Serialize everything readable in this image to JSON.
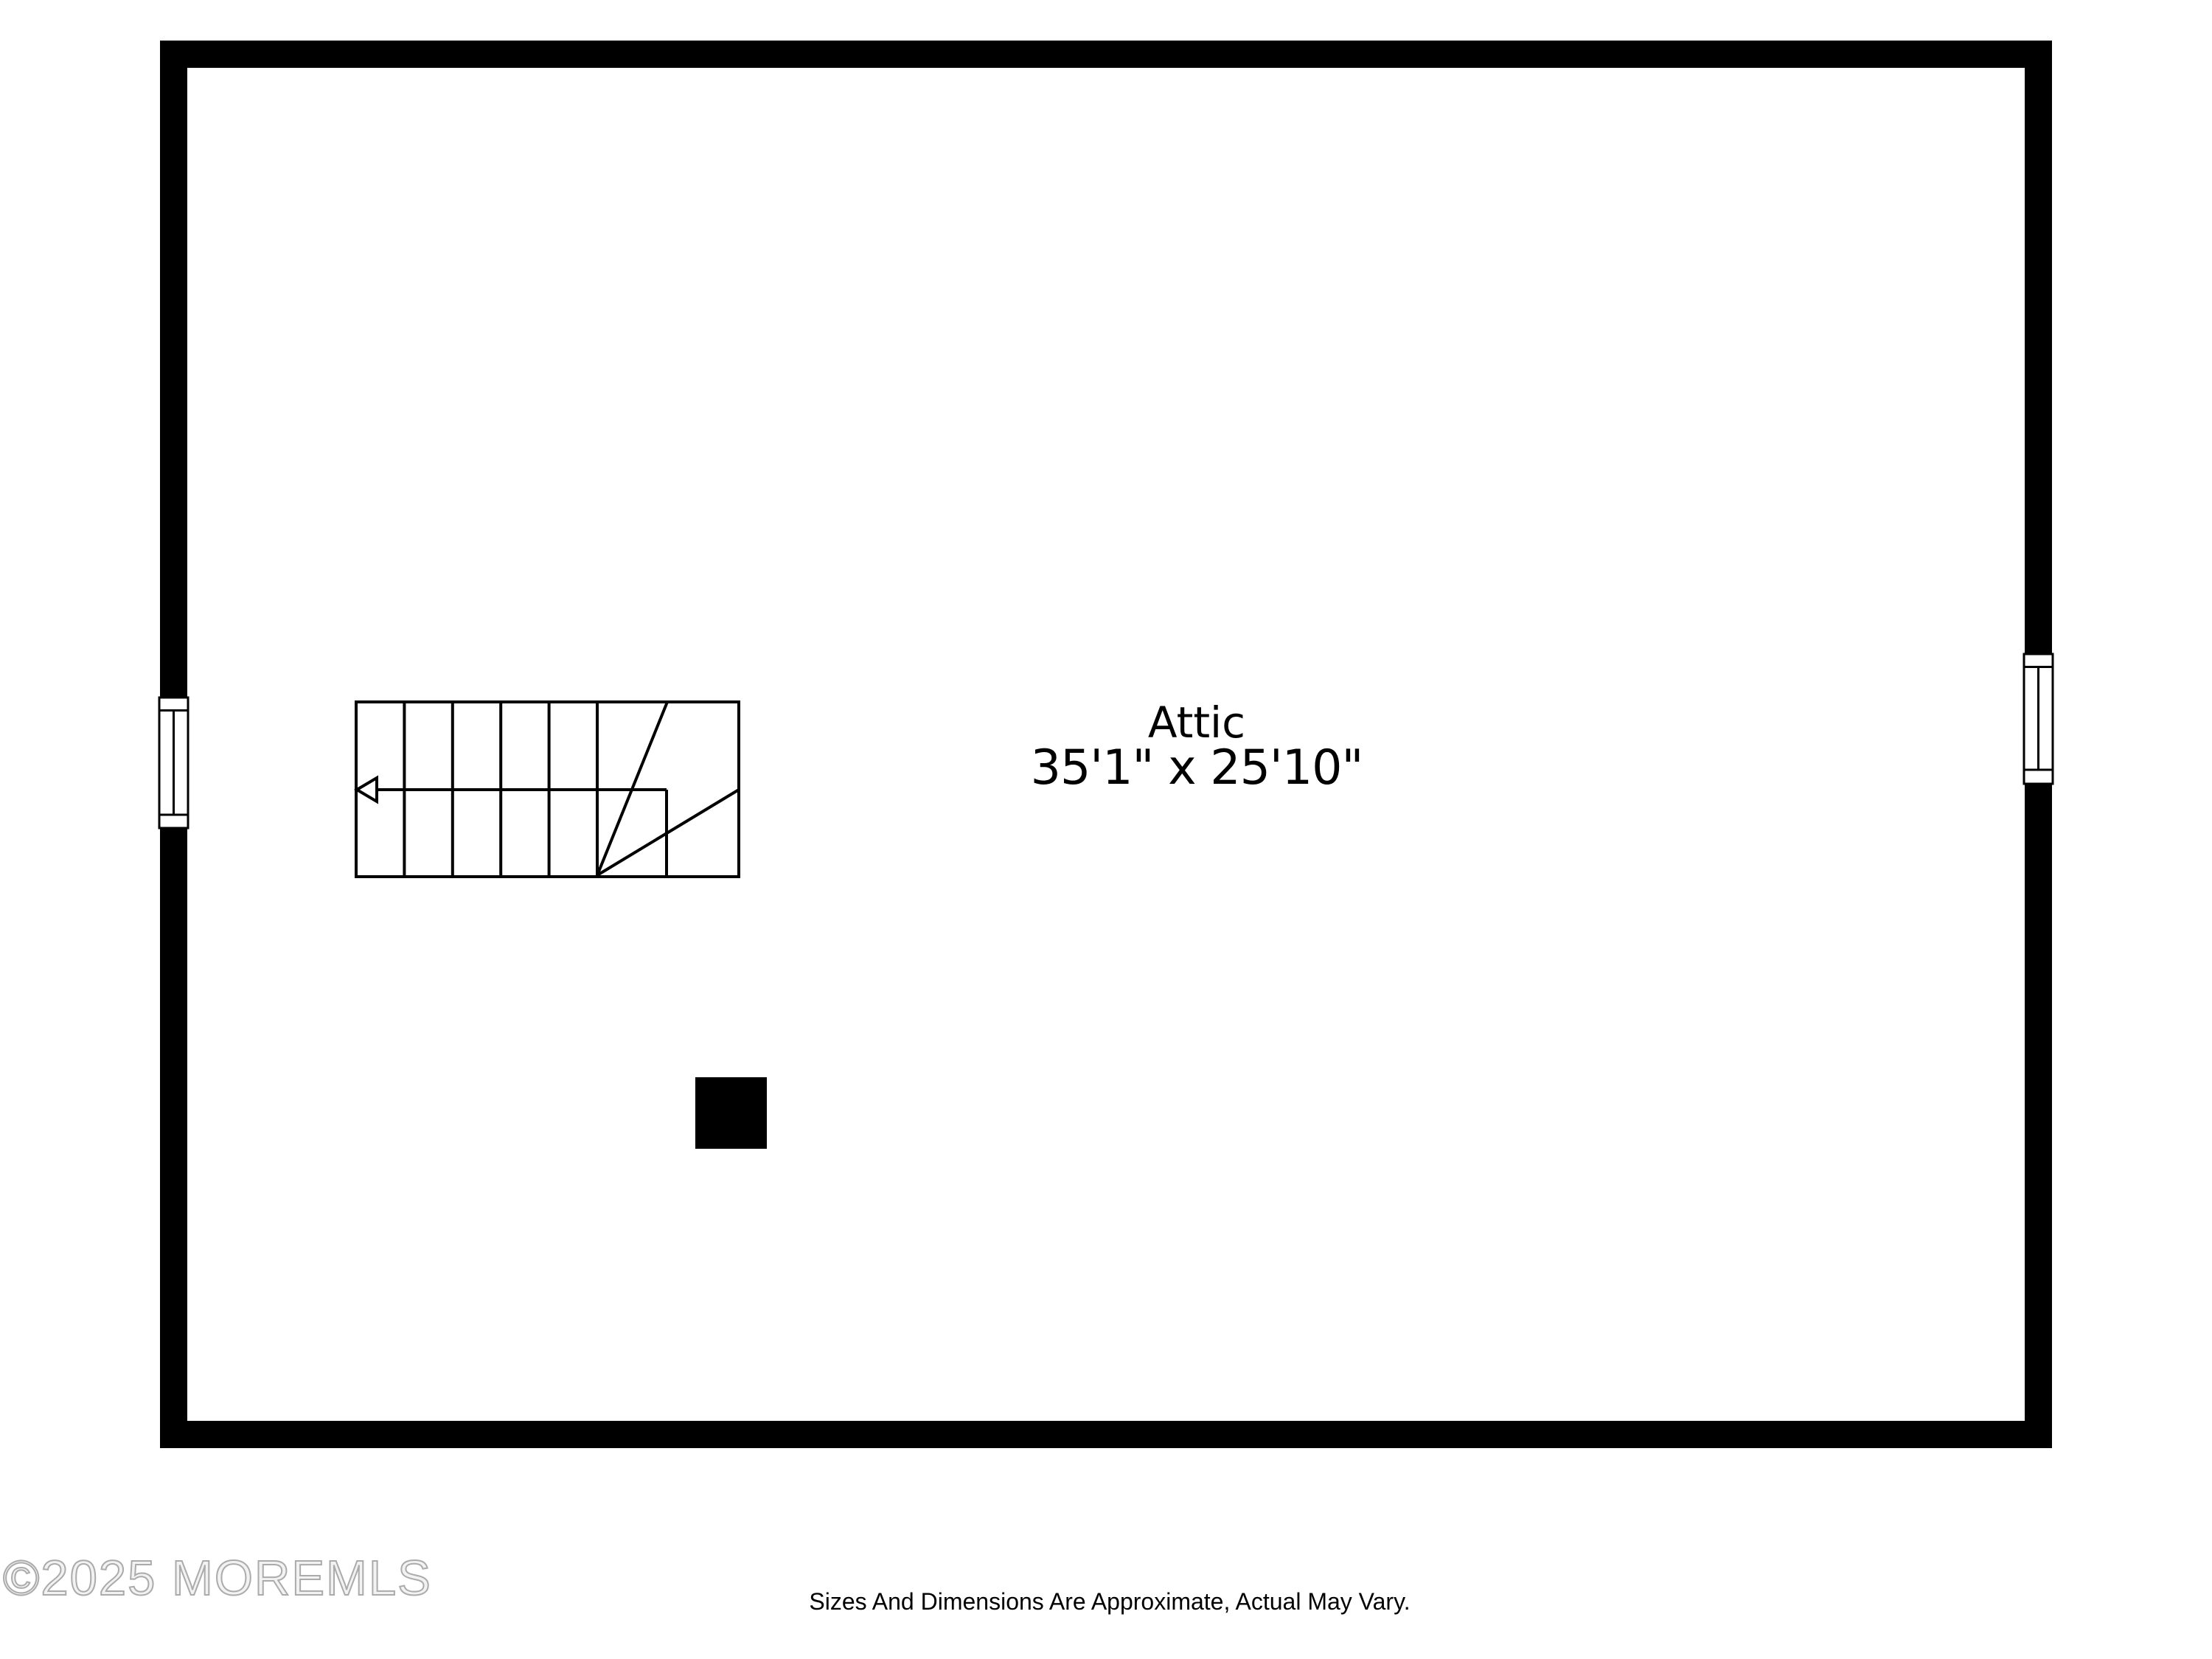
{
  "floorplan": {
    "room": {
      "name": "Attic",
      "dimensions": "35'1\" x 25'10\""
    },
    "watermark": "©2025 MOREMLS",
    "disclaimer": "Sizes And Dimensions Are Approximate, Actual May Vary.",
    "colors": {
      "wall": "#000000",
      "background": "#ffffff",
      "line": "#000000",
      "watermark": "#ababab"
    }
  }
}
